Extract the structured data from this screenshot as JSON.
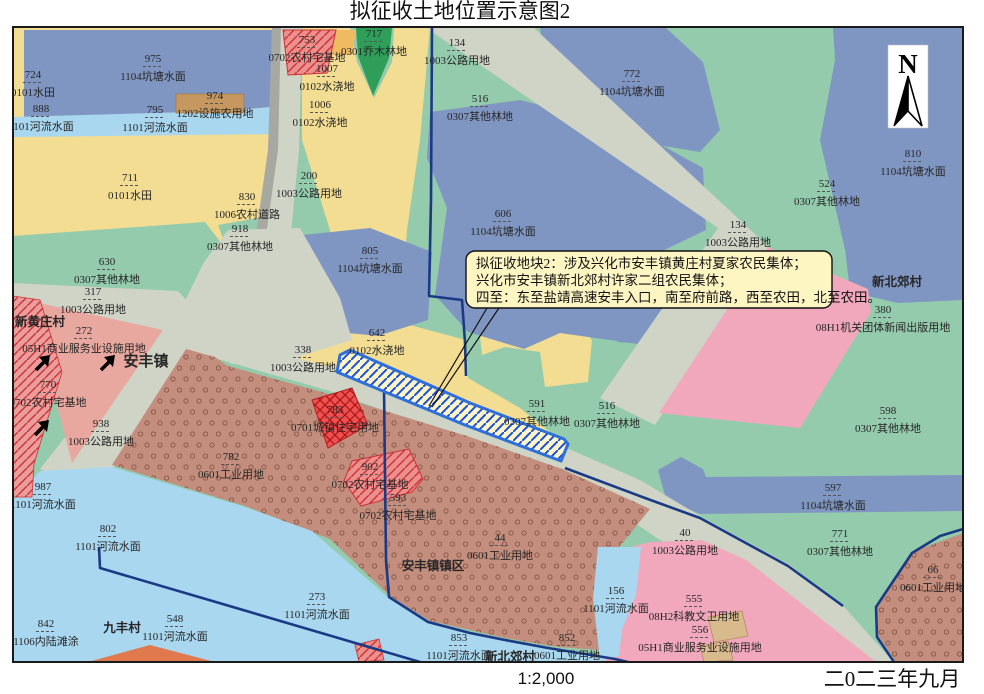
{
  "title": "拟征收土地位置示意图2",
  "footer": {
    "scale": "1:2,000",
    "date": "二0二三年九月"
  },
  "north_label": "N",
  "annotation": {
    "line1": "拟征收地块2：涉及兴化市安丰镇黄庄村夏家农民集体；",
    "line2": "兴化市安丰镇新北郊村许家二组农民集体；",
    "line3": "四至：东至盐靖高速安丰入口，南至府前路，西至农田，北至农田。"
  },
  "colors": {
    "base_green": "#94cbac",
    "pond_blue": "#8096c2",
    "river_blue": "#a9d7ef",
    "farm_yellow": "#f2dd92",
    "road_gray": "#cfd4c6",
    "rural_road_gray": "#a7a8a2",
    "facility_brown": "#c6985f",
    "arbor_green": "#2f9e58",
    "salmon_pink": "#e8a89f",
    "big_pink": "#f2a8bc",
    "dotted_brown": "#c38e7e",
    "red_parcel": "#eb8f8f",
    "red_bright": "#ef5050",
    "navy_boundary": "#1b3a85",
    "strip_blue": "#2e6fd9",
    "village_magenta": "#f318c3",
    "town_green": "#3ecb54",
    "orange": "#e07a4e",
    "tan": "#d9ba8d"
  },
  "parcels": [
    {
      "num": "724",
      "use": "0101水田",
      "x": 33,
      "y": 78
    },
    {
      "num": "975",
      "use": "1104坑塘水面",
      "x": 153,
      "y": 62
    },
    {
      "num": "974",
      "use": "1202设施农用地",
      "x": 215,
      "y": 99
    },
    {
      "num": "888",
      "use": "1101河流水面",
      "x": 41,
      "y": 112
    },
    {
      "num": "795",
      "use": "1101河流水面",
      "x": 155,
      "y": 113
    },
    {
      "num": "711",
      "use": "0101水田",
      "x": 130,
      "y": 181
    },
    {
      "num": "753",
      "use": "0702农村宅基地",
      "x": 307,
      "y": 43
    },
    {
      "num": "1007",
      "use": "0102水浇地",
      "x": 327,
      "y": 72
    },
    {
      "num": "717",
      "use": "0301乔木林地",
      "x": 374,
      "y": 37
    },
    {
      "num": "1006",
      "use": "0102水浇地",
      "x": 320,
      "y": 108
    },
    {
      "num": "200",
      "use": "1003公路用地",
      "x": 309,
      "y": 179
    },
    {
      "num": "830",
      "use": "1006农村道路",
      "x": 247,
      "y": 200
    },
    {
      "num": "918",
      "use": "0307其他林地",
      "x": 240,
      "y": 232
    },
    {
      "num": "134",
      "use": "1003公路用地",
      "x": 457,
      "y": 46
    },
    {
      "num": "516",
      "use": "0307其他林地",
      "x": 480,
      "y": 102
    },
    {
      "num": "772",
      "use": "1104坑塘水面",
      "x": 632,
      "y": 77
    },
    {
      "num": "606",
      "use": "1104坑塘水面",
      "x": 503,
      "y": 217
    },
    {
      "num": "810",
      "use": "1104坑塘水面",
      "x": 913,
      "y": 157
    },
    {
      "num": "524",
      "use": "0307其他林地",
      "x": 827,
      "y": 187
    },
    {
      "num": "134",
      "use": "1003公路用地",
      "x": 738,
      "y": 228
    },
    {
      "num": "630",
      "use": "0307其他林地",
      "x": 107,
      "y": 265
    },
    {
      "num": "317",
      "use": "1003公路用地",
      "x": 93,
      "y": 295
    },
    {
      "num": "272",
      "use": "05H1商业服务业设施用地",
      "x": 84,
      "y": 334
    },
    {
      "num": "770",
      "use": "0702农村宅基地",
      "x": 48,
      "y": 388
    },
    {
      "num": "938",
      "use": "1003公路用地",
      "x": 101,
      "y": 427
    },
    {
      "num": "805",
      "use": "1104坑塘水面",
      "x": 370,
      "y": 254
    },
    {
      "num": "642",
      "use": "0102水浇地",
      "x": 377,
      "y": 336
    },
    {
      "num": "338",
      "use": "1003公路用地",
      "x": 303,
      "y": 353
    },
    {
      "num": "783",
      "use": "0701城镇住宅用地",
      "x": 335,
      "y": 413
    },
    {
      "num": "782",
      "use": "0601工业用地",
      "x": 231,
      "y": 460
    },
    {
      "num": "902",
      "use": "0702农村宅基地",
      "x": 370,
      "y": 470
    },
    {
      "num": "593",
      "use": "0702农村宅基地",
      "x": 398,
      "y": 501
    },
    {
      "num": "44",
      "use": "0601工业用地",
      "x": 500,
      "y": 541
    },
    {
      "num": "40",
      "use": "1003公路用地",
      "x": 685,
      "y": 536
    },
    {
      "num": "591",
      "use": "0307其他林地",
      "x": 537,
      "y": 407
    },
    {
      "num": "516",
      "use": "0307其他林地",
      "x": 607,
      "y": 409
    },
    {
      "num": "598",
      "use": "0307其他林地",
      "x": 888,
      "y": 414
    },
    {
      "num": "380",
      "use": "08H1机关团体新闻出版用地",
      "x": 883,
      "y": 313
    },
    {
      "num": "597",
      "use": "1104坑塘水面",
      "x": 833,
      "y": 491
    },
    {
      "num": "771",
      "use": "0307其他林地",
      "x": 840,
      "y": 537
    },
    {
      "num": "987",
      "use": "1101河流水面",
      "x": 43,
      "y": 490
    },
    {
      "num": "802",
      "use": "1101河流水面",
      "x": 108,
      "y": 532
    },
    {
      "num": "842",
      "use": "1106内陆滩涂",
      "x": 46,
      "y": 627
    },
    {
      "num": "548",
      "use": "1101河流水面",
      "x": 175,
      "y": 622
    },
    {
      "num": "273",
      "use": "1101河流水面",
      "x": 317,
      "y": 600
    },
    {
      "num": "156",
      "use": "1101河流水面",
      "x": 616,
      "y": 594
    },
    {
      "num": "853",
      "use": "1101河流水面",
      "x": 459,
      "y": 641
    },
    {
      "num": "555",
      "use": "08H2科教文卫用地",
      "x": 694,
      "y": 602
    },
    {
      "num": "556",
      "use": "05H1商业服务业设施用地",
      "x": 700,
      "y": 633
    },
    {
      "num": "66",
      "use": "0601工业用地",
      "x": 933,
      "y": 573
    },
    {
      "num": "852",
      "use": "0601工业用地",
      "x": 567,
      "y": 641
    }
  ],
  "villages": [
    {
      "name": "新黄庄村",
      "x": 40,
      "y": 326,
      "type": "village"
    },
    {
      "name": "安丰镇",
      "x": 146,
      "y": 366,
      "type": "town"
    },
    {
      "name": "新北郊村",
      "x": 897,
      "y": 286,
      "type": "village"
    },
    {
      "name": "安丰镇镇区",
      "x": 433,
      "y": 570,
      "type": "village"
    },
    {
      "name": "九丰村",
      "x": 122,
      "y": 632,
      "type": "village"
    },
    {
      "name": "新北郊村",
      "x": 510,
      "y": 661,
      "type": "village"
    }
  ]
}
